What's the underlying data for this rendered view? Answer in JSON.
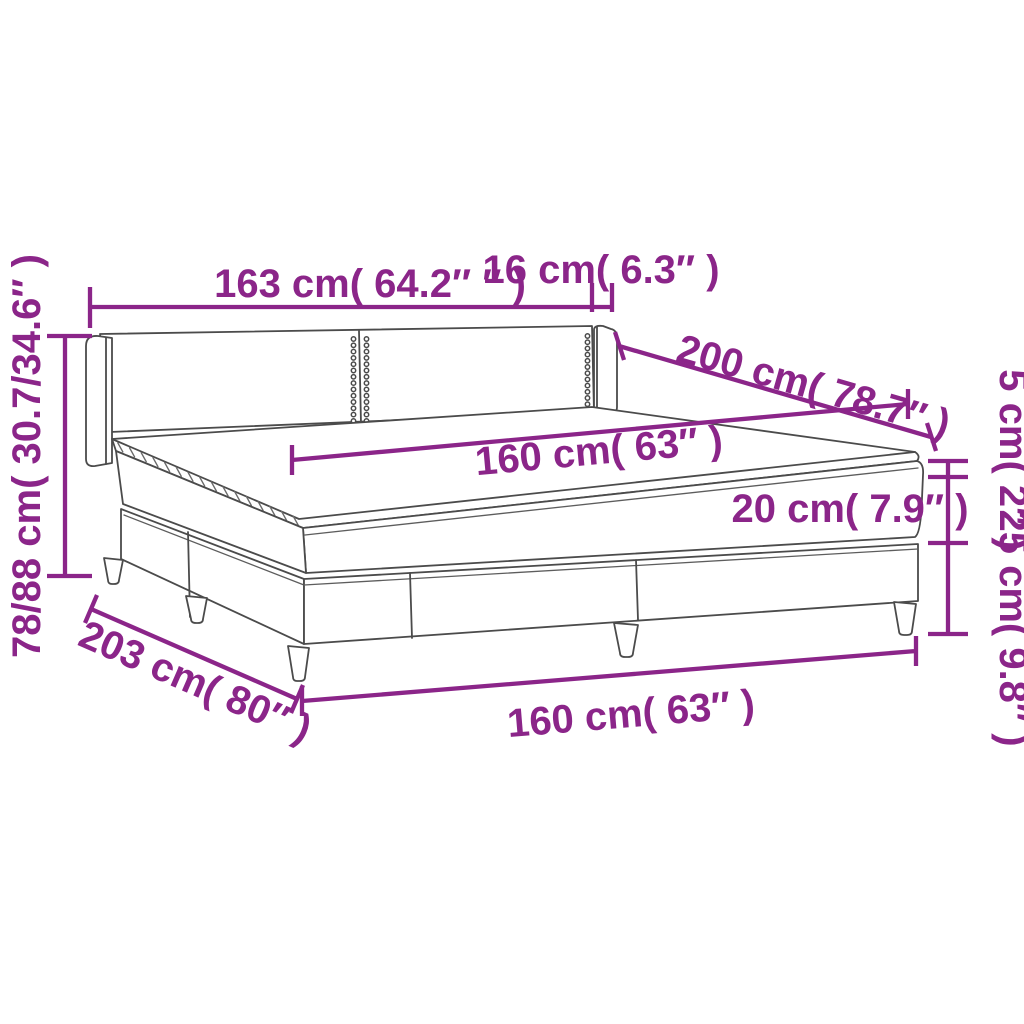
{
  "figure": {
    "type": "product-dimension-diagram",
    "subject": "box-spring-bed-with-headboard-topper-and-legs",
    "background": "#ffffff",
    "accent_color": "#8b2589",
    "line_color": "#4b4b4b"
  },
  "labels": {
    "headboard_width": "163 cm( 64.2″ ″ )",
    "headboard_wing_depth": "16 cm( 6.3″ )",
    "bed_length_top": "200 cm( 78.7″ )",
    "mattress_width": "160 cm( 63″ )",
    "topper_height": "5 cm( 2″ )",
    "mattress_height": "20 cm( 7.9″ )",
    "base_height": "25 cm( 9.8″ )",
    "headboard_height_range": "78/88 cm( 30.7/34.6″ )",
    "total_length": "203 cm( 80″ )",
    "base_width": "160 cm( 63″ )"
  }
}
